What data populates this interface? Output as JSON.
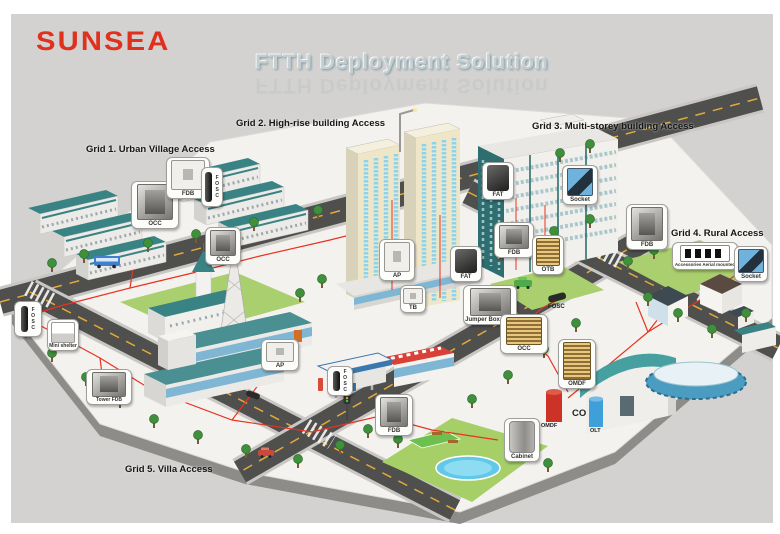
{
  "brand": {
    "logo": "SUNSEA"
  },
  "title": "FTTH Deployment Solution",
  "grids": [
    {
      "label": "Grid 1. Urban Village Access"
    },
    {
      "label": "Grid 2. High-rise building Access"
    },
    {
      "label": "Grid 3. Multi-storey building Access"
    },
    {
      "label": "Grid 4. Rural Access"
    },
    {
      "label": "Grid 5. Villa Access"
    }
  ],
  "callouts": [
    {
      "label": "OCC",
      "icon": "cabinet-icon"
    },
    {
      "label": "FDB",
      "icon": "terminal-box-icon"
    },
    {
      "label": "FOSC",
      "icon": "splice-closure-icon"
    },
    {
      "label": "OCC",
      "icon": "cabinet-icon"
    },
    {
      "label": "AP",
      "icon": "access-point-box-icon"
    },
    {
      "label": "FAT",
      "icon": "fiber-access-terminal-icon"
    },
    {
      "label": "TB",
      "icon": "terminal-box-icon"
    },
    {
      "label": "Jumper Box OCC",
      "icon": "cabinet-icon"
    },
    {
      "label": "FDB",
      "icon": "terminal-box-icon"
    },
    {
      "label": "OTB",
      "icon": "terminal-box-icon"
    },
    {
      "label": "FAT",
      "icon": "fiber-access-terminal-icon"
    },
    {
      "label": "Socket",
      "icon": "socket-icon"
    },
    {
      "label": "FDB",
      "icon": "cabinet-icon"
    },
    {
      "label": "Accessories Aerial mounted",
      "icon": "accessories-icon"
    },
    {
      "label": "Socket",
      "icon": "socket-icon"
    },
    {
      "label": "FOSC",
      "icon": "splice-closure-icon"
    },
    {
      "label": "Mini shelter",
      "icon": "shelter-icon"
    },
    {
      "label": "Tower FDB",
      "icon": "cabinet-icon"
    },
    {
      "label": "AP",
      "icon": "access-point-box-icon"
    },
    {
      "label": "FOSC",
      "icon": "splice-closure-icon"
    },
    {
      "label": "FDB",
      "icon": "cabinet-icon"
    },
    {
      "label": "OCC",
      "icon": "rack-icon"
    },
    {
      "label": "OMDF",
      "icon": "rack-icon"
    },
    {
      "label": "Cabinet",
      "icon": "cabinet-icon"
    }
  ],
  "equipment": {
    "fosc_road": "FOSC",
    "co": "CO",
    "omdf": "OMDF",
    "olt": "OLT"
  },
  "colors": {
    "brand_red": "#e0301e",
    "fiber_red": "#e73322",
    "roof_teal": "#3a8385",
    "road": "#4f4f4d"
  }
}
